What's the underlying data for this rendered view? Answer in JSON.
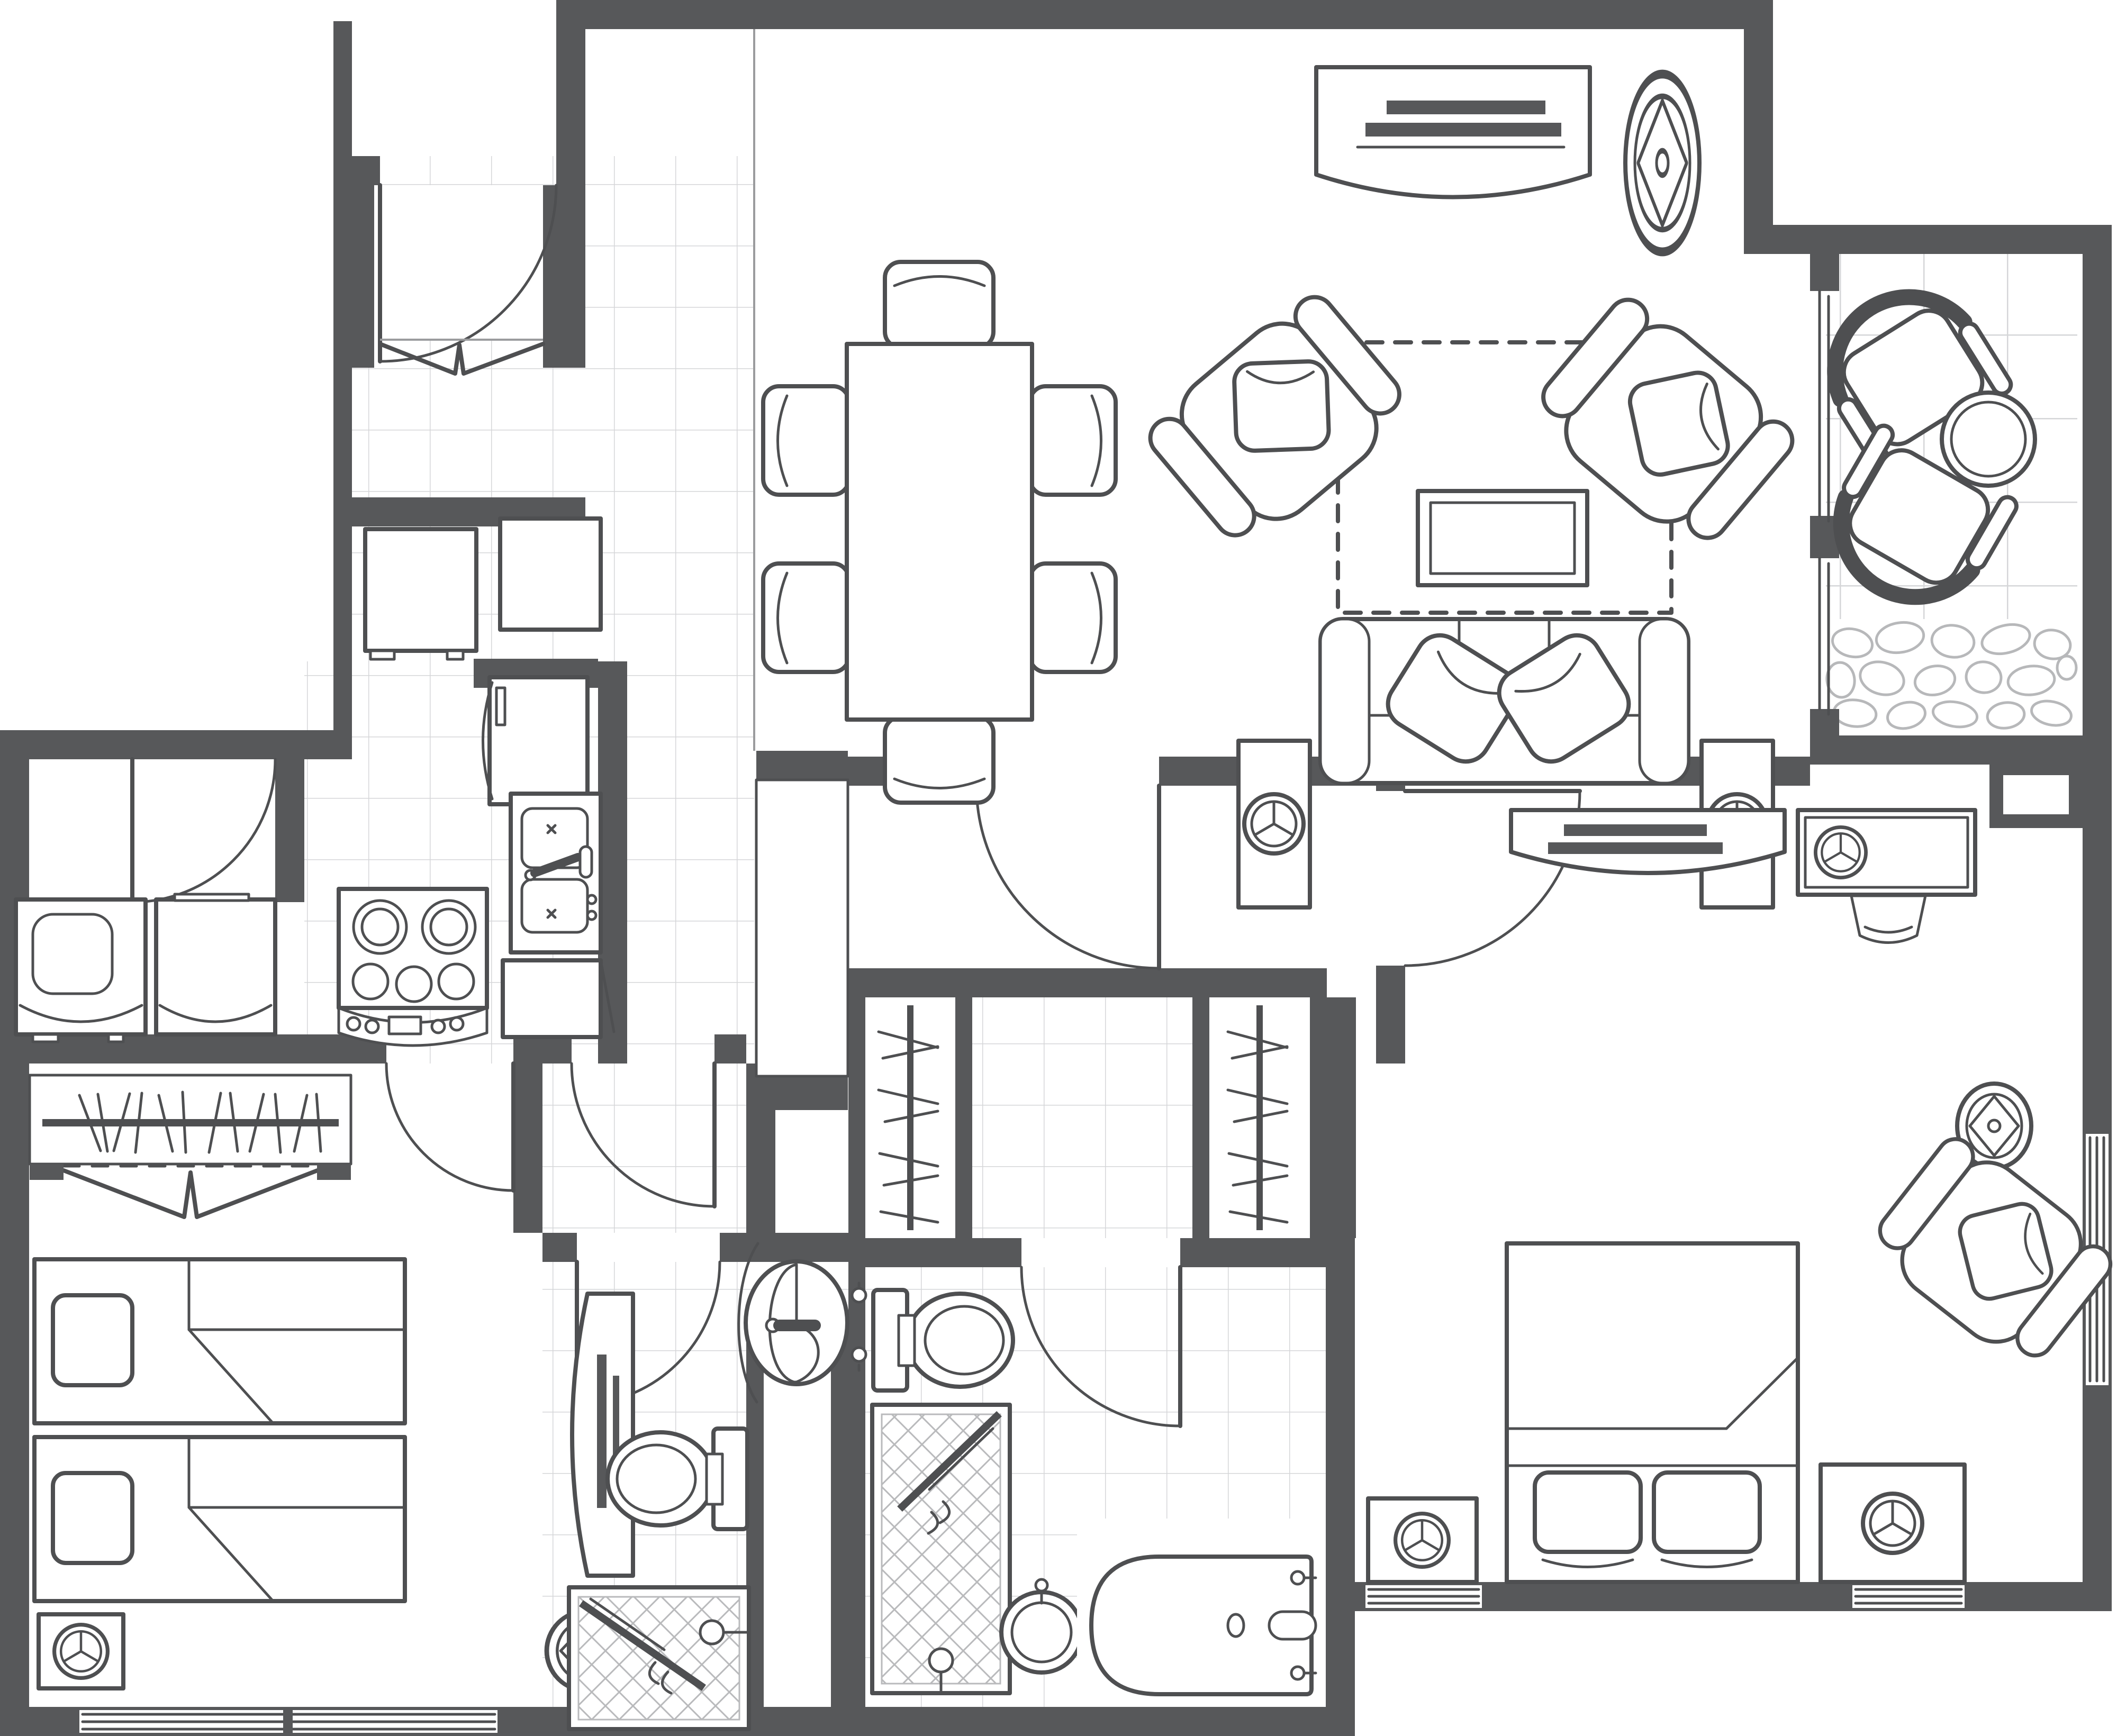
{
  "document": {
    "kind": "architectural-floor-plan",
    "description": "Top-down monochrome line-drawing floor plan of a two-bedroom, two-bath apartment suite with balcony",
    "text_labels": []
  },
  "palette": {
    "wall": "#57585a",
    "line": "#4e4f51",
    "line_light": "#9b9c9e",
    "tile": "#d5d6d8",
    "hatch": "#b9babc",
    "stone": "#b7b8ba",
    "floor": "#ffffff",
    "dash": "#4e4f51"
  },
  "rooms": [
    {
      "name": "foyer",
      "floor": "small-tile"
    },
    {
      "name": "entry-closet",
      "floor": "white"
    },
    {
      "name": "dining-room",
      "floor": "white"
    },
    {
      "name": "living-room",
      "floor": "white"
    },
    {
      "name": "balcony",
      "floor": "large-tile-and-stone"
    },
    {
      "name": "kitchen",
      "floor": "small-tile"
    },
    {
      "name": "laundry-nook",
      "floor": "white"
    },
    {
      "name": "hallway",
      "floor": "white"
    },
    {
      "name": "bedroom-2",
      "floor": "white"
    },
    {
      "name": "bath-vestibule-1",
      "floor": "small-tile"
    },
    {
      "name": "bathroom-1",
      "floor": "small-tile"
    },
    {
      "name": "linen-closet",
      "floor": "white"
    },
    {
      "name": "walk-in-closet-left",
      "floor": "white"
    },
    {
      "name": "walk-in-closet-right",
      "floor": "white"
    },
    {
      "name": "bath-vestibule-2",
      "floor": "small-tile"
    },
    {
      "name": "bathroom-2",
      "floor": "small-tile"
    },
    {
      "name": "master-bedroom",
      "floor": "white"
    },
    {
      "name": "master-wall-closet",
      "floor": "white"
    }
  ],
  "furniture": [
    "dining-table",
    "dining-chair x6",
    "sofa",
    "armchair x2",
    "coffee-table",
    "area-rug-dashed",
    "media-console-curved x2",
    "ceiling-speaker x3",
    "floor-speaker x5",
    "patio-chair x2",
    "patio-round-table",
    "desk-with-tv",
    "desk-chair",
    "recliner-armchair",
    "king-bed-with-pillows",
    "twin-bed x2",
    "tall-media-cabinet",
    "entry-side-table x2",
    "washer",
    "dryer",
    "refrigerator",
    "double-sink-counter",
    "cooktop-with-controls",
    "dishwasher",
    "pedestal-sink",
    "toilet x2",
    "shower-stall x2",
    "round-basin",
    "bathtub",
    "closet-rod-with-clothes x3",
    "bifold-doors x2"
  ],
  "openings": [
    "entry-door",
    "laundry-door",
    "bedroom-2-door",
    "vestibule-1-door",
    "bathroom-1-door",
    "hall-door",
    "master-bedroom-door",
    "bathroom-2-door",
    "balcony-sliding-doors",
    "bedroom-2-window",
    "master-windows x3",
    "shower-glass-door x2"
  ]
}
